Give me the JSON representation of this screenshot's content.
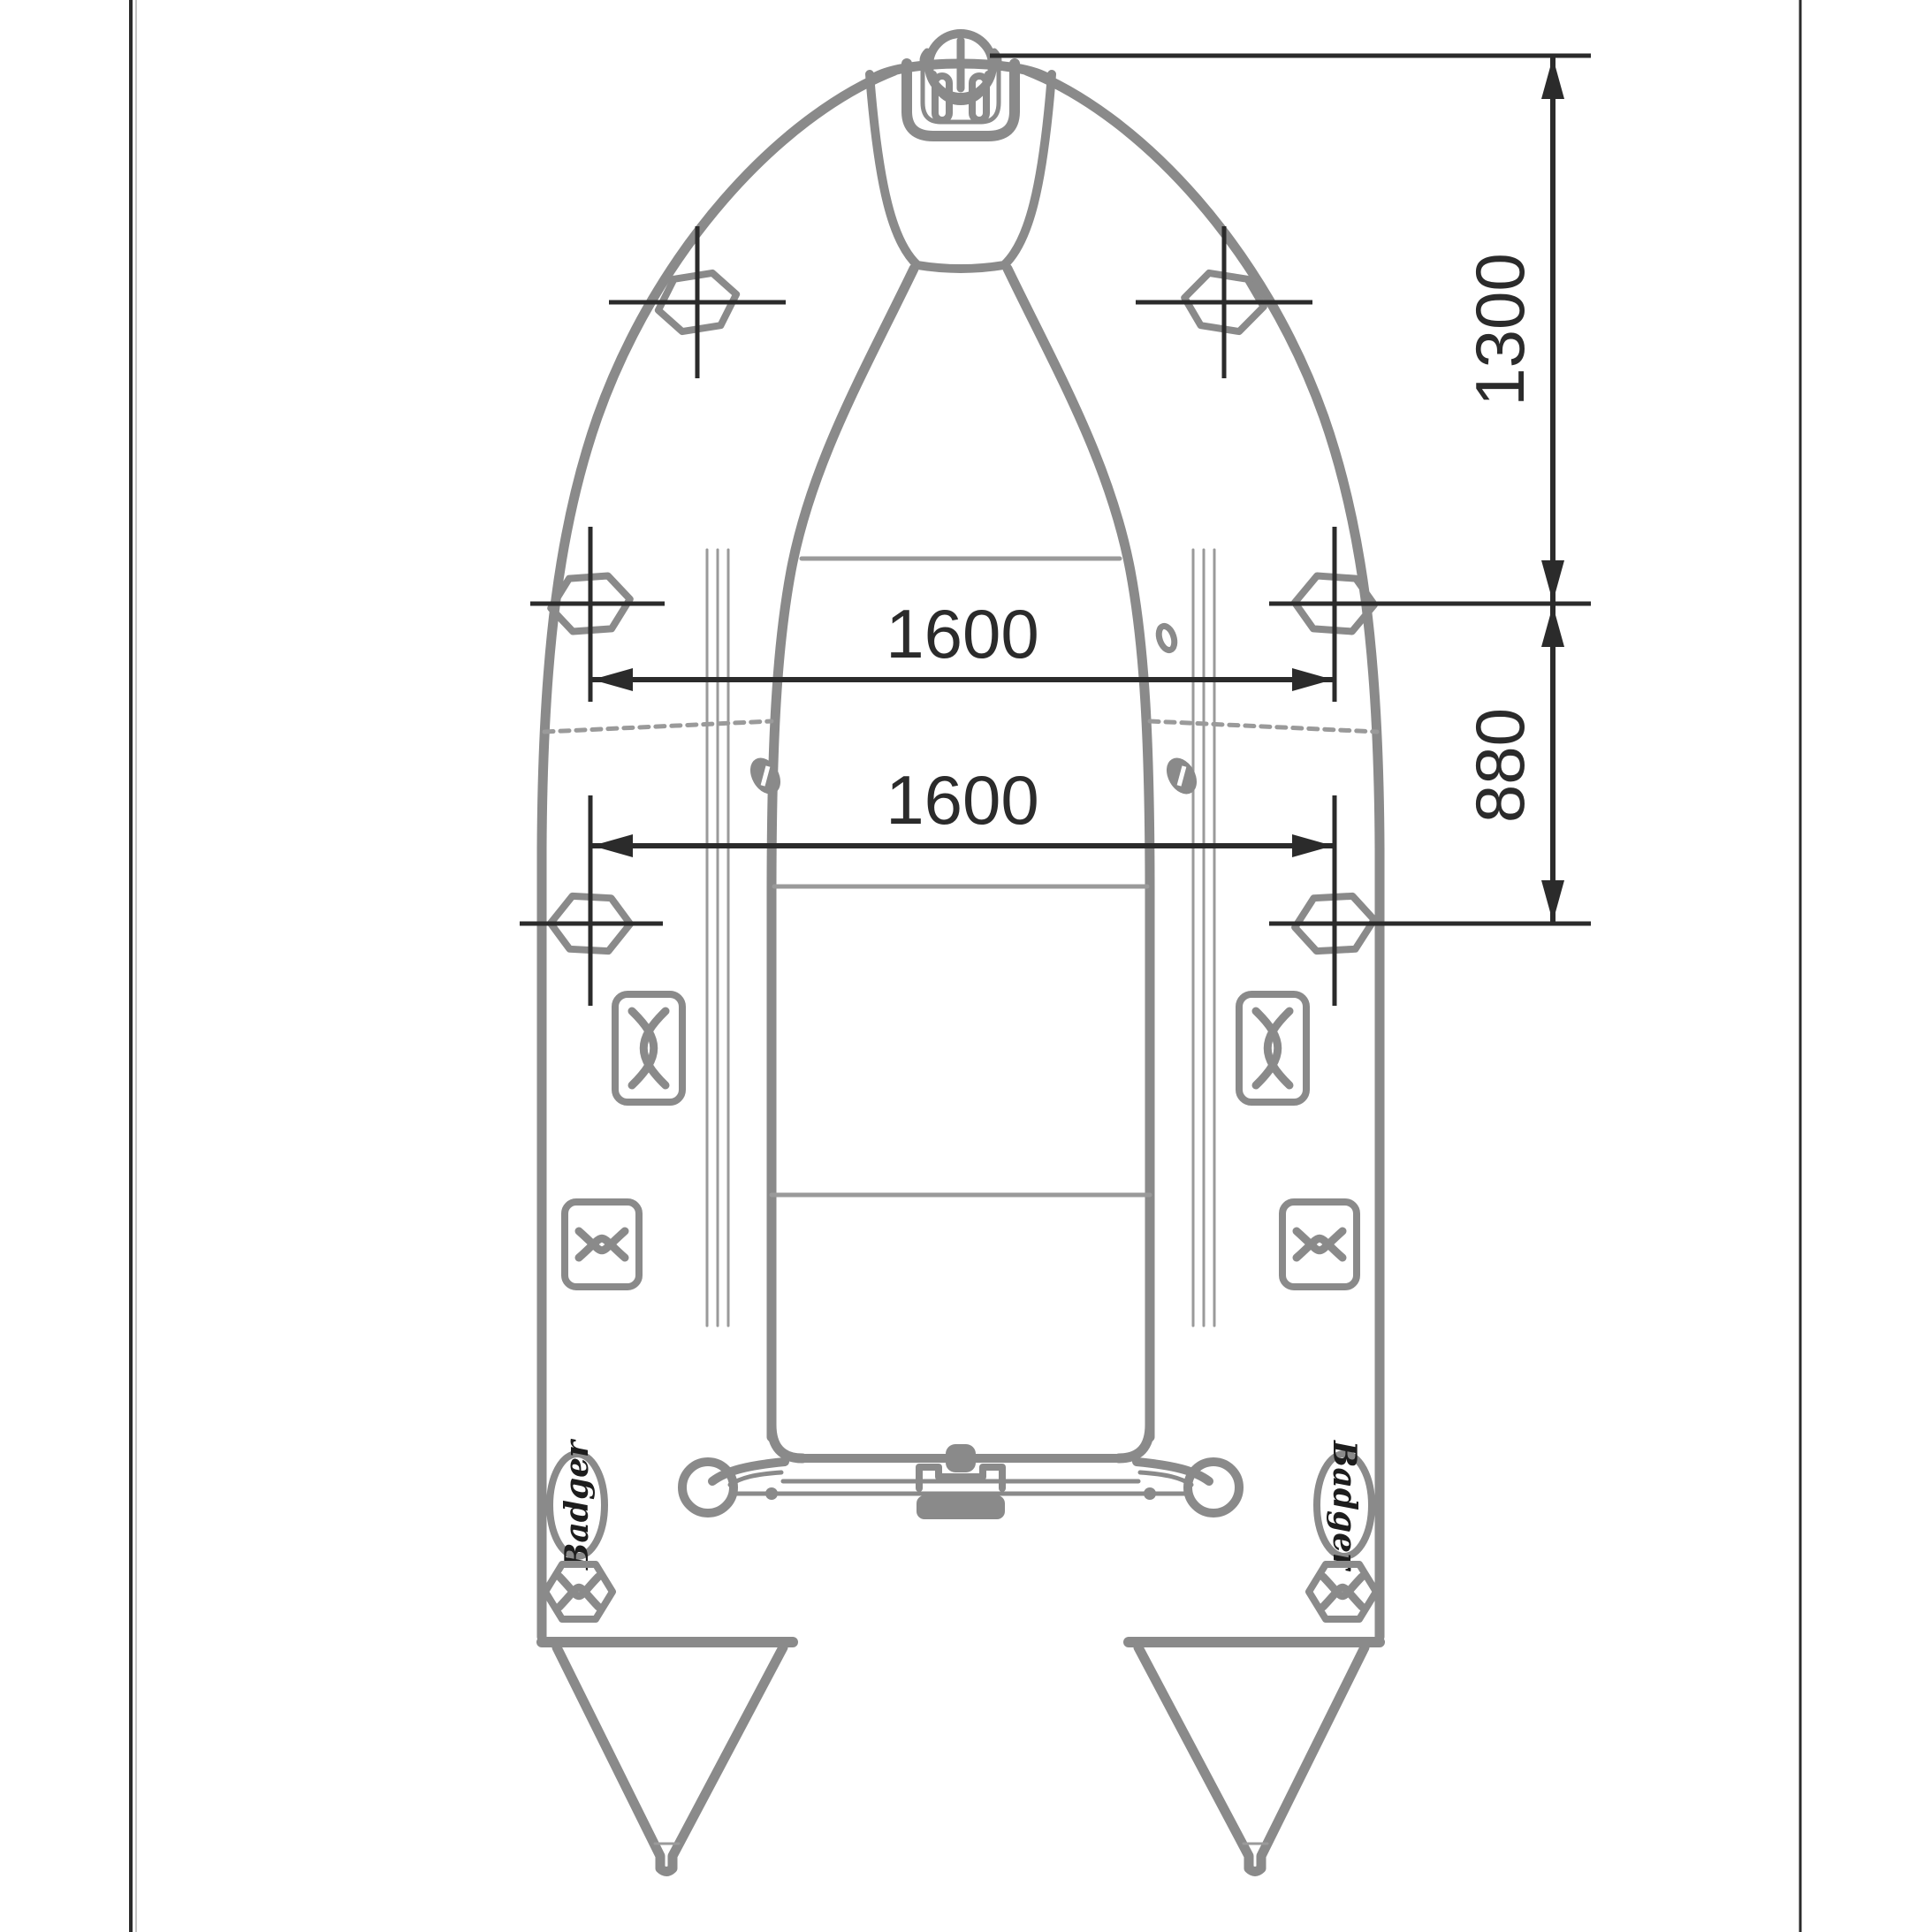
{
  "colors": {
    "line_gray": "#8a8a8a",
    "soft_gray": "#9a9a9a",
    "ink": "#2b2b2b",
    "paper": "#ffffff"
  },
  "dims": {
    "bow_to_row1": "1300",
    "row1_to_row2": "880",
    "row1_width": "1600",
    "row2_width": "1600"
  },
  "brand": {
    "left": "Badger",
    "right": "Badger"
  },
  "fittings": [
    "bow-carry-handle",
    "hex-crosshair-fitting",
    "oar-lock-grommet",
    "lace-handle-fitting",
    "bowtie-fitting",
    "badger-logo-patch",
    "stern-hex-fitting",
    "transom-motor-mount",
    "transom-end-ring",
    "stern-cone"
  ]
}
